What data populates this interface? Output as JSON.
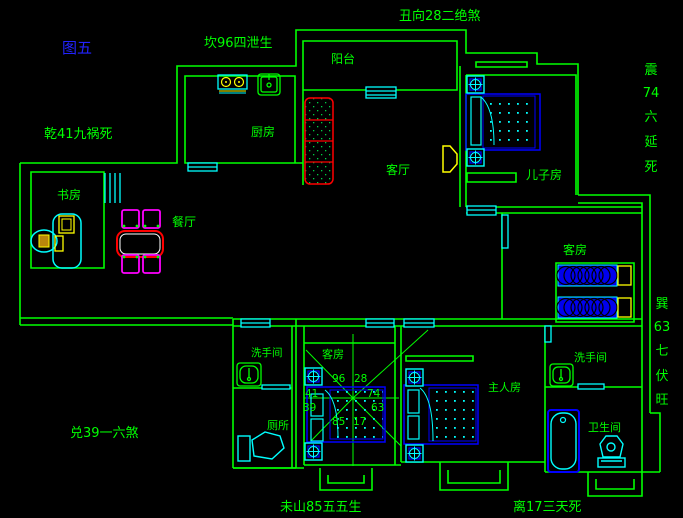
{
  "title": "图五",
  "perimeter_labels": {
    "north": "坎96四泄生",
    "northeast": "丑向28二绝煞",
    "northwest": "乾41九祸死",
    "west": "兑39一六煞",
    "south_left": "未山85五五生",
    "south_right": "离17三天死",
    "east_vertical": [
      "震",
      "74",
      "六",
      "延",
      "死"
    ],
    "southeast_vertical": [
      "巽",
      "63",
      "七",
      "伏",
      "旺"
    ]
  },
  "room_labels": {
    "balcony": "阳台",
    "kitchen": "厨房",
    "living_room": "客厅",
    "sons_room": "儿子房",
    "study": "书房",
    "dining_room": "餐厅",
    "guest_room_east": "客房",
    "guest_room_center": "客房",
    "washroom_west": "洗手间",
    "toilet": "厕所",
    "master_room": "主人房",
    "washroom_east": "洗手间",
    "bathroom": "卫生间"
  },
  "compass_numbers": [
    "96",
    "28",
    "41",
    "74",
    "39",
    "63",
    "85",
    "17"
  ],
  "colors": {
    "background": "#000000",
    "walls": "#00ff00",
    "windows_doors": "#00ffff",
    "beds": "#0000ff",
    "sofa_table": "#ff0000",
    "chairs": "#ff00ff",
    "appliances": "#ffff00",
    "title": "#2222ff"
  }
}
